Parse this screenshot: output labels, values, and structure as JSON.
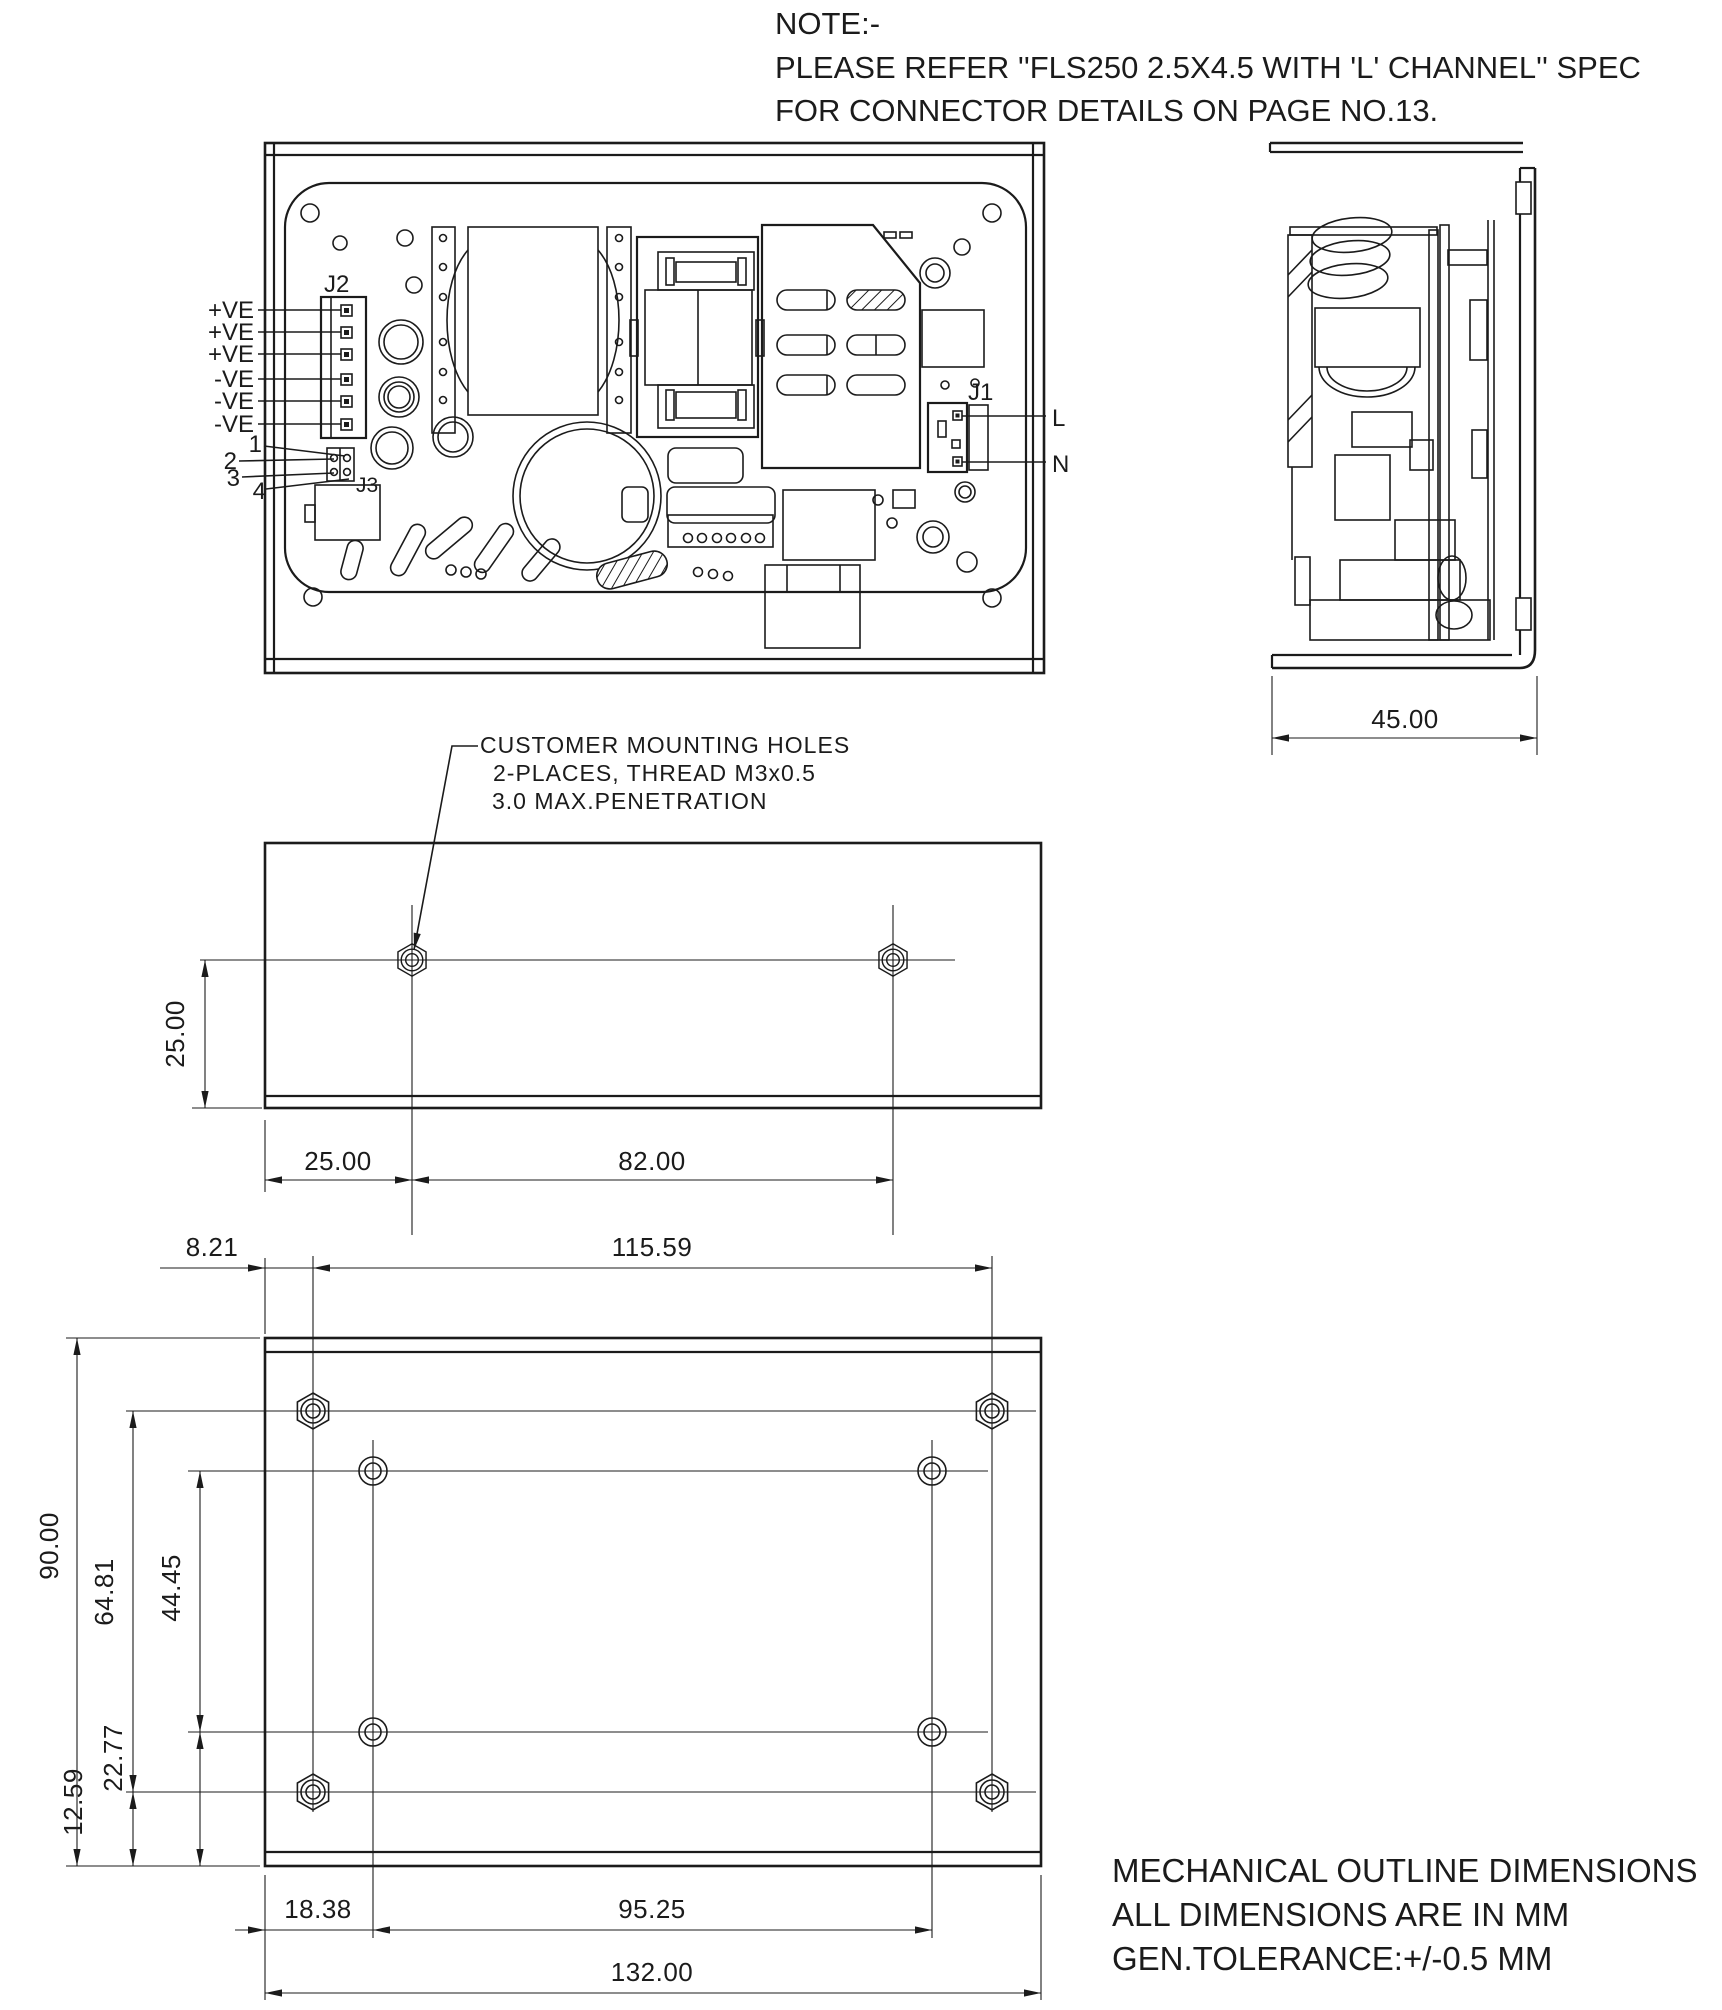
{
  "page": {
    "background": "#ffffff",
    "ink": "#1b1b1b"
  },
  "note": {
    "line1": "NOTE:-",
    "line2": "PLEASE REFER ''FLS250 2.5X4.5 WITH 'L' CHANNEL'' SPEC",
    "line3": "FOR CONNECTOR DETAILS ON PAGE NO.13."
  },
  "top_view": {
    "j2_label": "J2",
    "j3_label": "J3",
    "j1_label": "J1",
    "output_pins": [
      "+VE",
      "+VE",
      "+VE",
      "-VE",
      "-VE",
      "-VE"
    ],
    "aux_pins": [
      "1",
      "2",
      "3",
      "4"
    ],
    "line_label": "L",
    "neutral_label": "N"
  },
  "mounting_callout": {
    "line1": "CUSTOMER MOUNTING HOLES",
    "line2": "2-PLACES, THREAD M3x0.5",
    "line3": "3.0 MAX.PENETRATION"
  },
  "dims": {
    "side_depth": "45.00",
    "front_hole_height": "25.00",
    "front_hole_left": "25.00",
    "front_hole_span": "82.00",
    "base_hex_left": "8.21",
    "base_hex_span": "115.59",
    "base_height": "90.00",
    "base_hex_vspan": "64.81",
    "base_round_vspan": "44.45",
    "base_round_bottom": "22.77",
    "base_hex_bottom": "12.59",
    "base_round_left": "18.38",
    "base_round_span": "95.25",
    "base_width": "132.00"
  },
  "footer": {
    "line1": "MECHANICAL OUTLINE DIMENSIONS",
    "line2": "ALL DIMENSIONS ARE IN MM",
    "line3": "GEN.TOLERANCE:+/-0.5 MM"
  }
}
